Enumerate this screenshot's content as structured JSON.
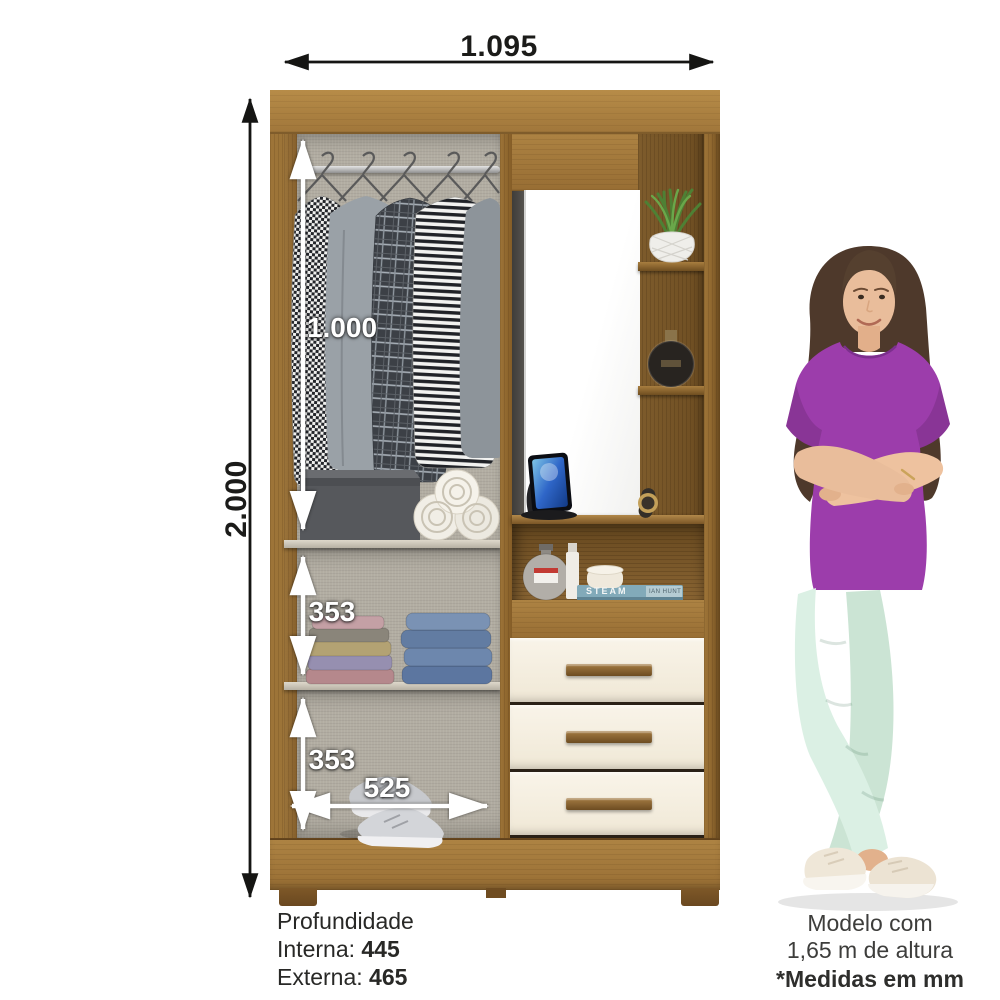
{
  "annotations": {
    "width_top": "1.095",
    "height_total": "2.000",
    "hanging_height": "1.000",
    "shelf_1_height": "353",
    "shelf_2_height": "353",
    "interior_width": "525"
  },
  "depth_info": {
    "title": "Profundidade",
    "rows": [
      {
        "label": "Interna: ",
        "value": "445"
      },
      {
        "label": "Externa: ",
        "value": "465"
      }
    ]
  },
  "model_note": {
    "line1": "Modelo com",
    "line2": "1,65 m de altura"
  },
  "footnote": "*Medidas em mm",
  "book": {
    "title": "STEAM",
    "author": "IAN HUNT"
  },
  "colors": {
    "wood": "#a0783c",
    "drawer_front": "#f6f0e3",
    "interior_fabric": "#b2ada2",
    "top_purple": "#9c3dab",
    "pants_mint": "#d9eee2",
    "dimension_text": "#1b1b19"
  }
}
